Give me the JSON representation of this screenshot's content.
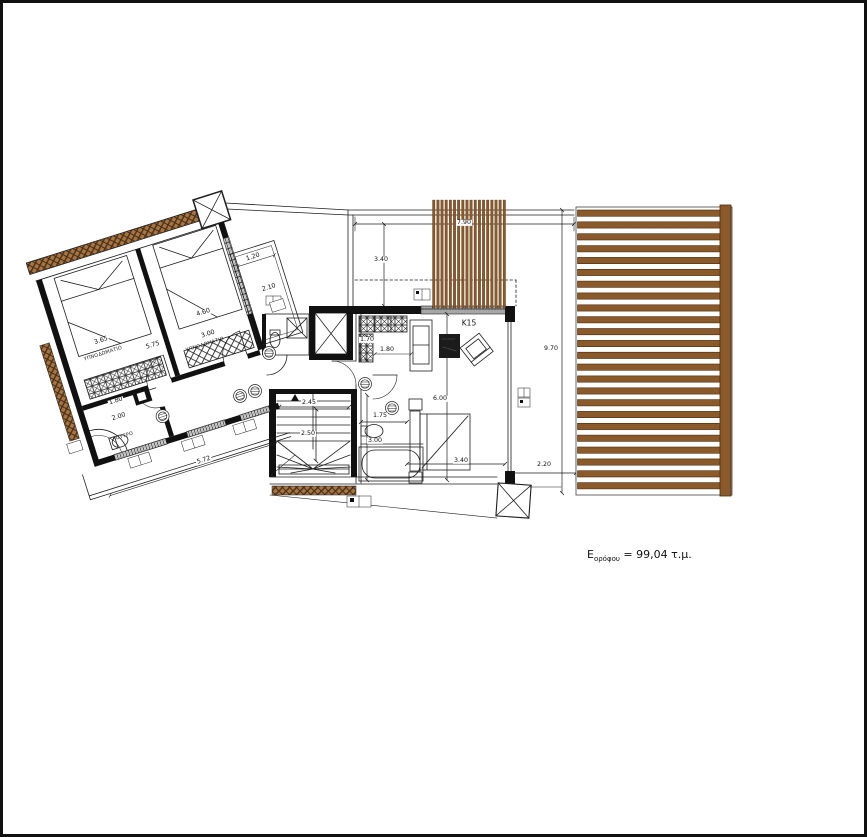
{
  "drawing": {
    "type": "floor-plan",
    "area_label": {
      "prefix": "E",
      "subscript": "ορόφου",
      "suffix": " = 99,04 τ.μ."
    },
    "rooms": {
      "bedroom1": "ΥΠΝΟΔΩΜΑΤΙΟ",
      "bedroom2": "ΥΠΝΟΔΩΜΑΤΙΟ",
      "bathroom": "ΛΟΥΤΡΟ"
    },
    "codes": {
      "k15": "K15"
    },
    "dims": {
      "terrace_width": "7.90",
      "terrace_depth": "3.40",
      "side_length": "9.70",
      "living_length": "6.00",
      "bed_width": "3.40",
      "terrace_right": "2.20",
      "closet_depth": "1.70",
      "closet_width": "1.80",
      "wc_width": "1.75",
      "wc_length": "3.00",
      "stair_width": "2.45",
      "stair_depth": "2.50",
      "bedroom1_width": "3.65",
      "bedroom2_width": "3.00",
      "bedrooms_span": "5.75",
      "bedroom_depth": "4.60",
      "small_balcony_width": "1.20",
      "small_balcony_length": "2.10",
      "bath_width": "1.80",
      "bath_length": "2.00",
      "balcony_length": "5.72"
    },
    "colors": {
      "wood": "#8a5a2b",
      "wood_dark": "#4a2c10",
      "line": "#1e1e1e"
    }
  }
}
